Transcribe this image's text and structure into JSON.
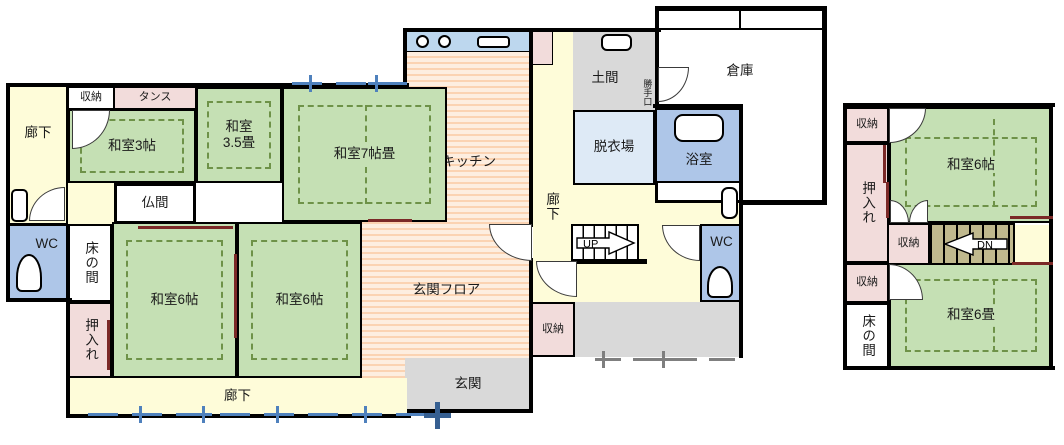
{
  "floor1": {
    "corridor_left": "廊下",
    "closet_top": "収納",
    "tansu": "タンス",
    "washitsu_3jo": "和室3帖",
    "washitsu_35_line1": "和室",
    "washitsu_35_line2": "3.5畳",
    "washitsu_7jo": "和室7帖畳",
    "butsuma": "仏間",
    "wc_left": "WC",
    "tokonoma": "床の間",
    "oshiire": "押入れ",
    "washitsu_6jo_a": "和室6帖",
    "washitsu_6jo_b": "和室6帖",
    "corridor_bottom": "廊下",
    "kitchen": "キッチン",
    "corridor_center": "廊下",
    "doma": "土間",
    "katteguchi": "勝手口",
    "souko": "倉庫",
    "datsuiba": "脱衣場",
    "yokushitsu": "浴室",
    "stairs_up": "UP",
    "wc_right": "WC",
    "closet_center": "収納",
    "genkan_floor": "玄関フロア",
    "genkan": "玄関"
  },
  "floor2": {
    "closet_top": "収納",
    "oshiire": "押入れ",
    "washitsu_6jo": "和室6帖",
    "closet_mid": "収納",
    "stairs_down": "DN",
    "closet_bottom": "収納",
    "tokonoma": "床の間",
    "washitsu_6jou": "和室6畳"
  },
  "colors": {
    "wall": "#000000",
    "tatami_green": "#C5E0B4",
    "tatami_line": "#6E9248",
    "corridor_yellow": "#FEFCD9",
    "closet_pink": "#F2DCDB",
    "bath_blue": "#AEC6E8",
    "dressing_blue": "#DEEAF6",
    "counter_blue": "#BDD7EE",
    "floor_gray": "#D9D9D9",
    "stripe_orange": "#FBD3B2",
    "stairs_tan": "#C0B98E",
    "dimension_blue": "#4F81BD",
    "dimension_gray": "#7F7F7F",
    "fusuma_maroon": "#7B2927"
  }
}
